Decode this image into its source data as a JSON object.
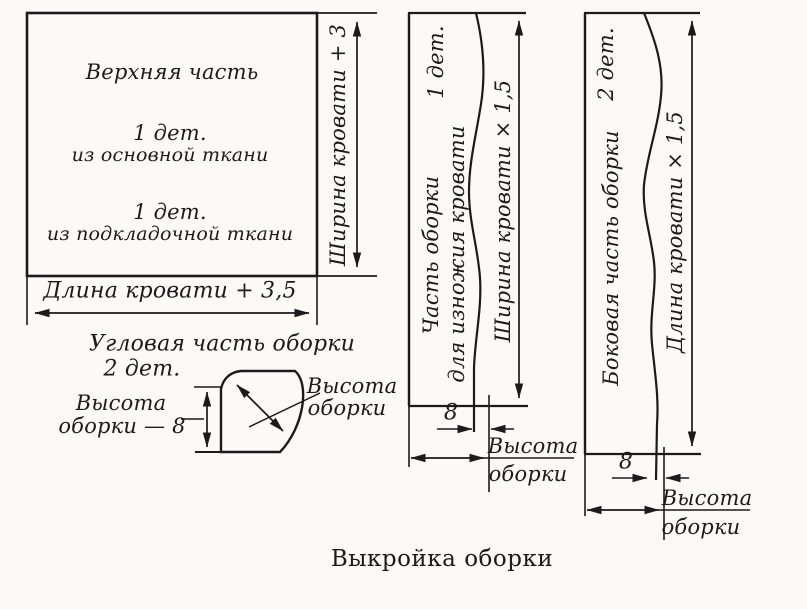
{
  "title": "Выкройка оборки",
  "top_piece": {
    "name": "Верхняя часть",
    "count1": "1 дет.",
    "fabric1": "из основной ткани",
    "count2": "1 дет.",
    "fabric2": "из подкладочной ткани",
    "width_label": "Ширина кровати + 3",
    "length_label": "Длина кровати + 3,5"
  },
  "corner_piece": {
    "title": "Угловая часть оборки",
    "count": "2 дет.",
    "left_label": {
      "line1": "Высота",
      "line2": "оборки — 8"
    },
    "right_label": {
      "line1": "Высота",
      "line2": "оборки"
    }
  },
  "foot_piece": {
    "count": "1 дет.",
    "name_line1": "Часть оборки",
    "name_line2": "для изножия кровати",
    "width_label": "Ширина кровати × 1,5",
    "seam_width": "8",
    "height_label": {
      "line1": "Высота",
      "line2": "оборки"
    }
  },
  "side_piece": {
    "count": "2 дет.",
    "name": "Боковая часть оборки",
    "length_label": "Длина кровати × 1,5",
    "seam_width": "8",
    "height_label": {
      "line1": "Высота",
      "line2": "оборки"
    }
  },
  "ink_color": "#1b1b1b",
  "paper_color": "#fbfaf7"
}
